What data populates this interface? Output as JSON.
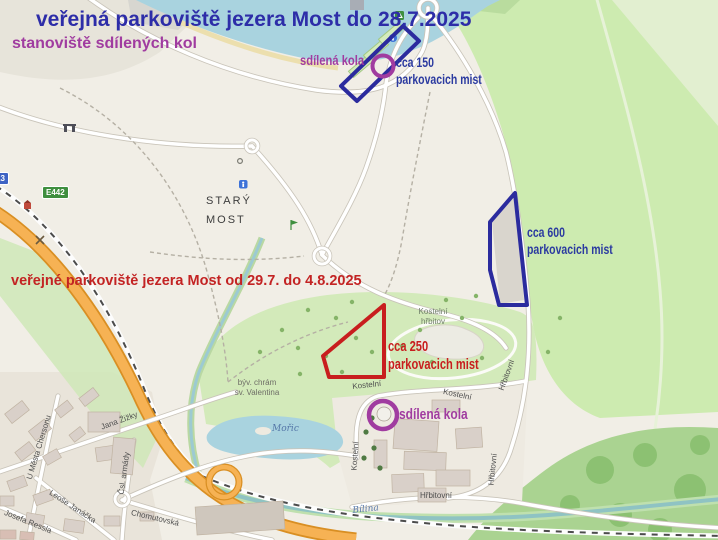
{
  "overlay": {
    "title_blue": "veřejná parkoviště jezera Most do 28.7.2025",
    "subtitle_bikes": "stanoviště sdílených kol",
    "bike_label_top": "sdílená kola",
    "bike_label_bottom": "sdílená kola",
    "parking150_line1": "cca 150",
    "parking150_line2": "parkovacich mist",
    "parking600_line1": "cca 600",
    "parking600_line2": "parkovacich mist",
    "parking250_line1": "cca 250",
    "parking250_line2": "parkovacich mist",
    "title_red": "veřejné parkoviště jezera Most od 29.7. do 4.8.2025"
  },
  "map": {
    "place_line1": "STARÝ",
    "place_line2": "MOST",
    "cemetery_line1": "Kostelní",
    "cemetery_line2": "hřbitov",
    "church_line1": "býv. chrám",
    "church_line2": "sv. Valentina",
    "pond": "Mořic",
    "river": "Bílina",
    "streets": {
      "jana_zizky": "Jana Žižky",
      "u_mesta_chersonu": "U Města Chersonu",
      "leose_janacka": "Leoše Janáčka",
      "josefa_ressla": "Josefa Ressla",
      "csl_armady": "Čsl. armády",
      "chomutovska": "Chomutovská",
      "hrbitovni": "Hřbitovní",
      "kostelni": "Kostelní"
    },
    "shields": {
      "e442": "E442",
      "route13": "13"
    }
  },
  "colors": {
    "annotation_blue": "#2b2b9e",
    "annotation_red": "#c81e1e",
    "annotation_purple": "#a03ca0",
    "text_blue": "#2d2da8",
    "water": "#a9d3df",
    "grass": "#cdebb0",
    "forest": "#aad391",
    "highway_orange": "#f6b254"
  }
}
